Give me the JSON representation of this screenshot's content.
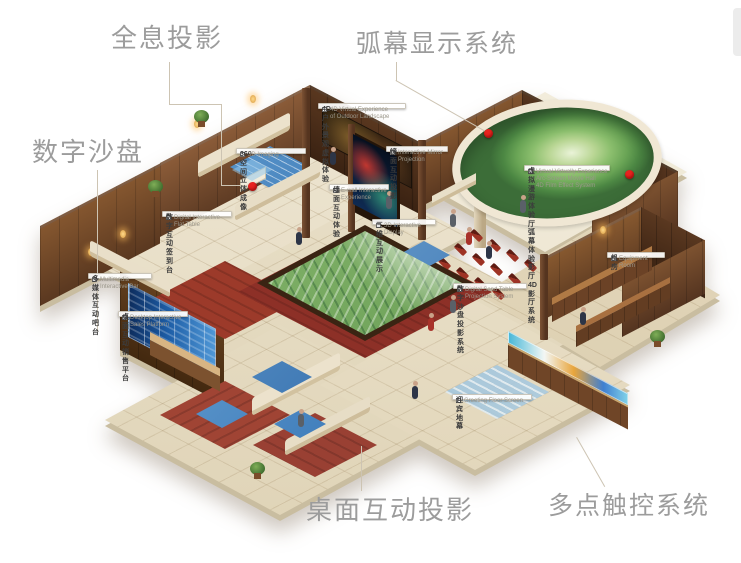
{
  "main_labels": {
    "holographic": "全息投影",
    "arc_screen": "弧幕显示系统",
    "sand_table": "数字沙盘",
    "desktop_projection": "桌面互动投影",
    "multitouch": "多点触控系统"
  },
  "callouts": [
    {
      "id": "4d-outdoor-experience",
      "zh": "4D 户外景观虚拟体验",
      "en": "4D Virtual Experience\nof Outdoor Landscape"
    },
    {
      "id": "360-imaging",
      "zh": "360 空间立体成像",
      "en": "3D Imaging"
    },
    {
      "id": "mirror-projection",
      "zh": "镜面互动投影",
      "en": "Interactive Mirror\nProjection"
    },
    {
      "id": "wall-interactive",
      "zh": "墙面互动体验",
      "en": "E-wall Interactive\nExperience"
    },
    {
      "id": "3d-display",
      "zh": "三维互动展示",
      "en": "3D Interactive Display"
    },
    {
      "id": "virtual-roaming-hall",
      "zh": "虚拟漫游体验厅\n弧幕体验影厅\n4D 影厅系统",
      "en": "Virtual Virtually Experience\nArc-Screen Movie Hall\n4D Film Effect System"
    },
    {
      "id": "equipment-room",
      "zh": "机房",
      "en": "Equipment Room"
    },
    {
      "id": "digital-sign-table",
      "zh": "数字互动签到台",
      "en": "Digital Interactive\nFlat Table"
    },
    {
      "id": "multimedia-bar",
      "zh": "多媒体互动吧台",
      "en": "Multimedia\nInteractive Bar"
    },
    {
      "id": "desktop-sales-platform",
      "zh": "桌面互动销售平台",
      "en": "Desktop Interactive\nSales Platform"
    },
    {
      "id": "sand-table-projection",
      "zh": "数字沙盘投影系统",
      "en": "Digital Sand Table\nProjection System"
    },
    {
      "id": "greeting-floor-screen",
      "zh": "迎宾地幕",
      "en": "Greeting Floor Screen"
    }
  ],
  "colors": {
    "marker_red": "#e8231f",
    "label_gray": "#9c9c9c",
    "wall_brown": "#5d3b26",
    "floor_beige": "#e9e1cc",
    "dome_green": "#6fa455"
  }
}
